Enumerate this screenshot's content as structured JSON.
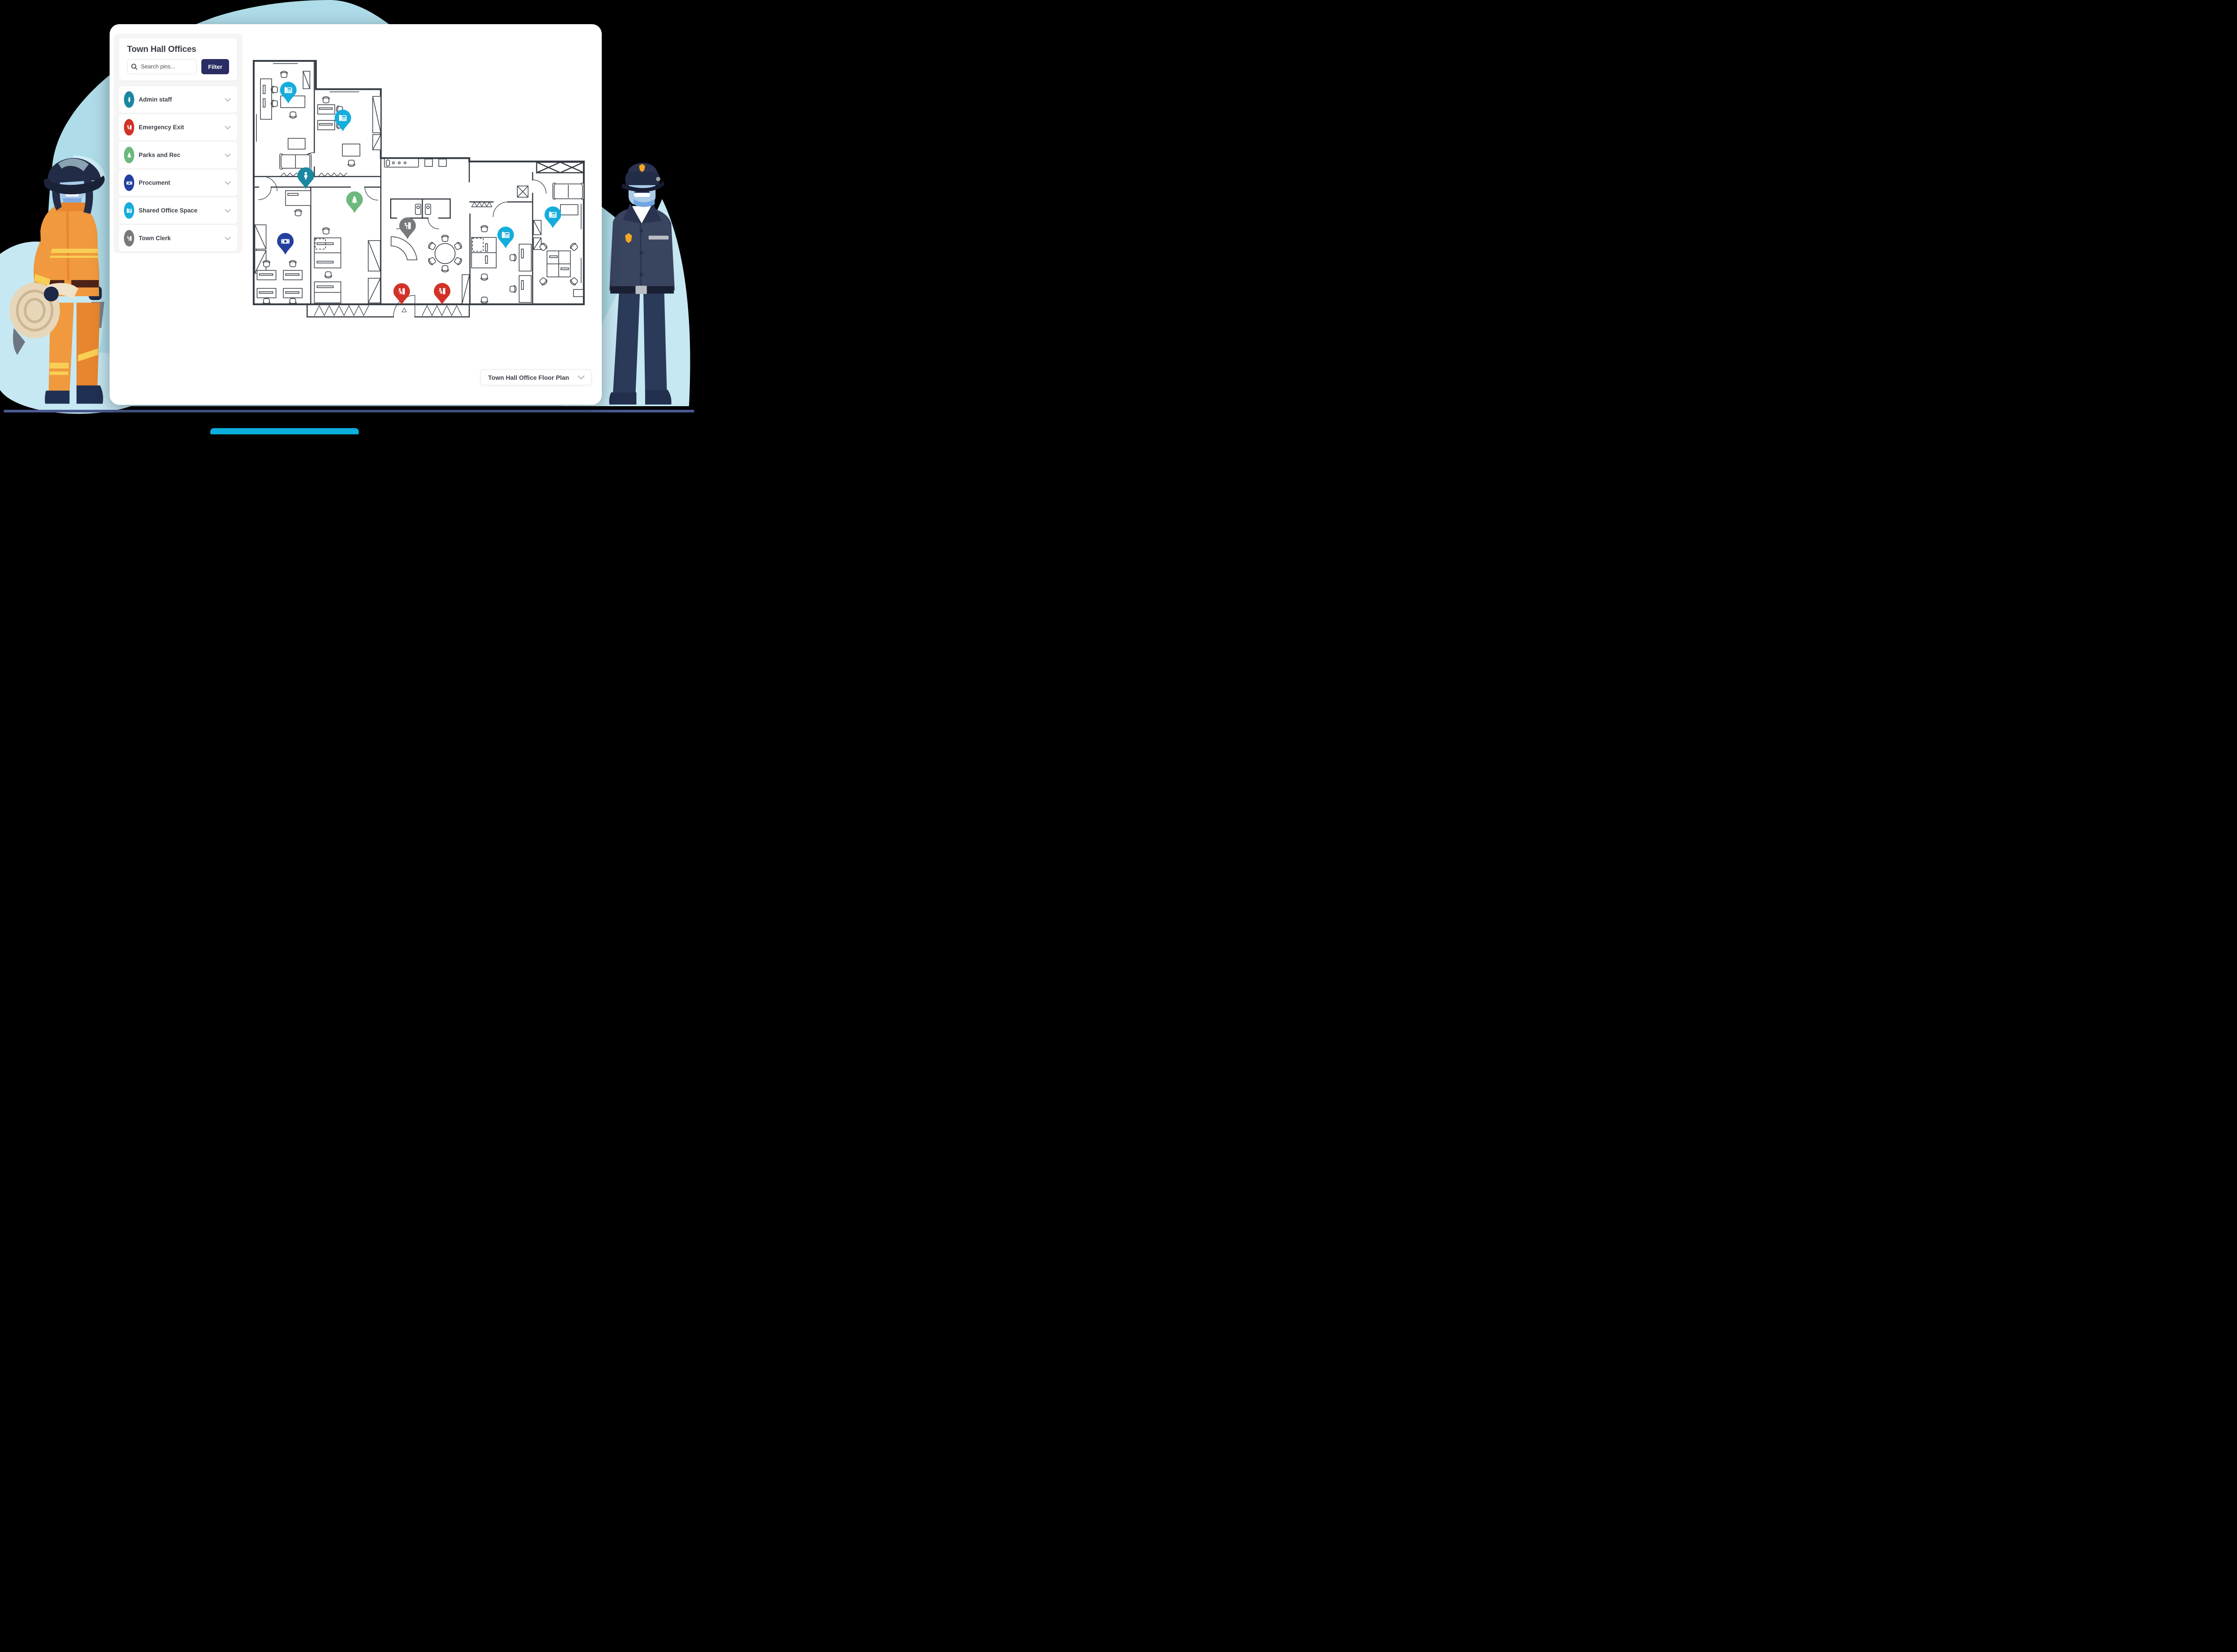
{
  "app": {
    "background_color": "#000000",
    "blob_color": "#AFDCE9",
    "blob_light_color": "#C6E8F3",
    "ground_color": "#4A5A8F",
    "accent_bar_color": "#0BAEDC"
  },
  "sidebar": {
    "title": "Town Hall Offices",
    "search": {
      "placeholder": "Search pins...",
      "icon": "search-icon"
    },
    "filter_button": {
      "label": "Filter",
      "color": "#2A2D63"
    },
    "categories": [
      {
        "label": "Admin staff",
        "icon": "person-icon",
        "color": "#1B87A0"
      },
      {
        "label": "Emergency Exit",
        "icon": "exit-run-icon",
        "color": "#D23227"
      },
      {
        "label": "Parks and Rec",
        "icon": "tree-icon",
        "color": "#6CB87D"
      },
      {
        "label": "Procument",
        "icon": "money-icon",
        "color": "#233F9F"
      },
      {
        "label": "Shared Office Space",
        "icon": "fax-phone-icon",
        "color": "#14ADDC"
      },
      {
        "label": "Town Clerk",
        "icon": "clerk-door-icon",
        "color": "#77797B"
      }
    ]
  },
  "map": {
    "name": "Town Hall Office floor plan",
    "line_color": "#333A42",
    "dropdown": {
      "value": "Town Hall Office Floor Plan",
      "icon": "chevron-down-icon"
    },
    "pins": [
      {
        "category": "Shared Office Space",
        "color": "#14ADDC",
        "x_pct": 11.9,
        "y_pct": 15.4
      },
      {
        "category": "Shared Office Space",
        "color": "#14ADDC",
        "x_pct": 27.5,
        "y_pct": 25.3
      },
      {
        "category": "Admin staff",
        "color": "#1B87A0",
        "x_pct": 16.9,
        "y_pct": 45.7
      },
      {
        "category": "Parks and Rec",
        "color": "#6CB87D",
        "x_pct": 30.9,
        "y_pct": 54.3
      },
      {
        "category": "Procument",
        "color": "#233F9F",
        "x_pct": 11.0,
        "y_pct": 69.0
      },
      {
        "category": "Town Clerk",
        "color": "#77797B",
        "x_pct": 46.1,
        "y_pct": 63.5
      },
      {
        "category": "Emergency Exit",
        "color": "#D23227",
        "x_pct": 44.5,
        "y_pct": 86.8
      },
      {
        "category": "Emergency Exit",
        "color": "#D23227",
        "x_pct": 56.1,
        "y_pct": 86.7
      },
      {
        "category": "Shared Office Space",
        "color": "#14ADDC",
        "x_pct": 74.3,
        "y_pct": 66.7
      },
      {
        "category": "Shared Office Space",
        "color": "#14ADDC",
        "x_pct": 87.9,
        "y_pct": 59.6
      }
    ]
  },
  "illustrations": {
    "left": {
      "name": "firefighter holding fire hose"
    },
    "right": {
      "name": "police officer"
    }
  }
}
